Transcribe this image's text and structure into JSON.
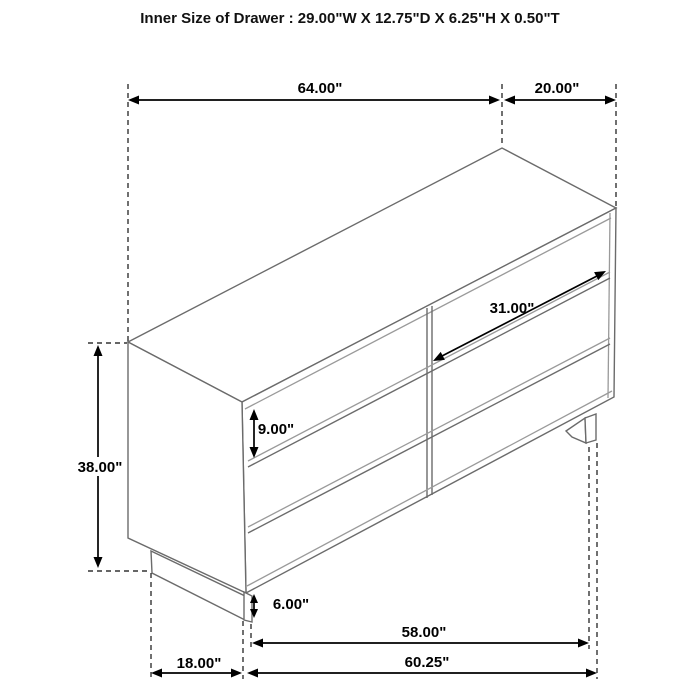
{
  "title": "Inner Size of Drawer : 29.00\"W X 12.75\"D X 6.25\"H X 0.50\"T",
  "dimensions": {
    "top_width": "64.00\"",
    "top_depth": "20.00\"",
    "overall_height": "38.00\"",
    "drawer_front_width": "31.00\"",
    "drawer_front_height": "9.00\"",
    "base_height": "6.00\"",
    "base_front_width": "58.00\"",
    "side_floor_depth": "18.00\"",
    "overall_front_width": "60.25\""
  },
  "colors": {
    "background": "#ffffff",
    "furniture_line": "#6b6b6b",
    "dimension_line": "#000000",
    "text": "#000000"
  }
}
